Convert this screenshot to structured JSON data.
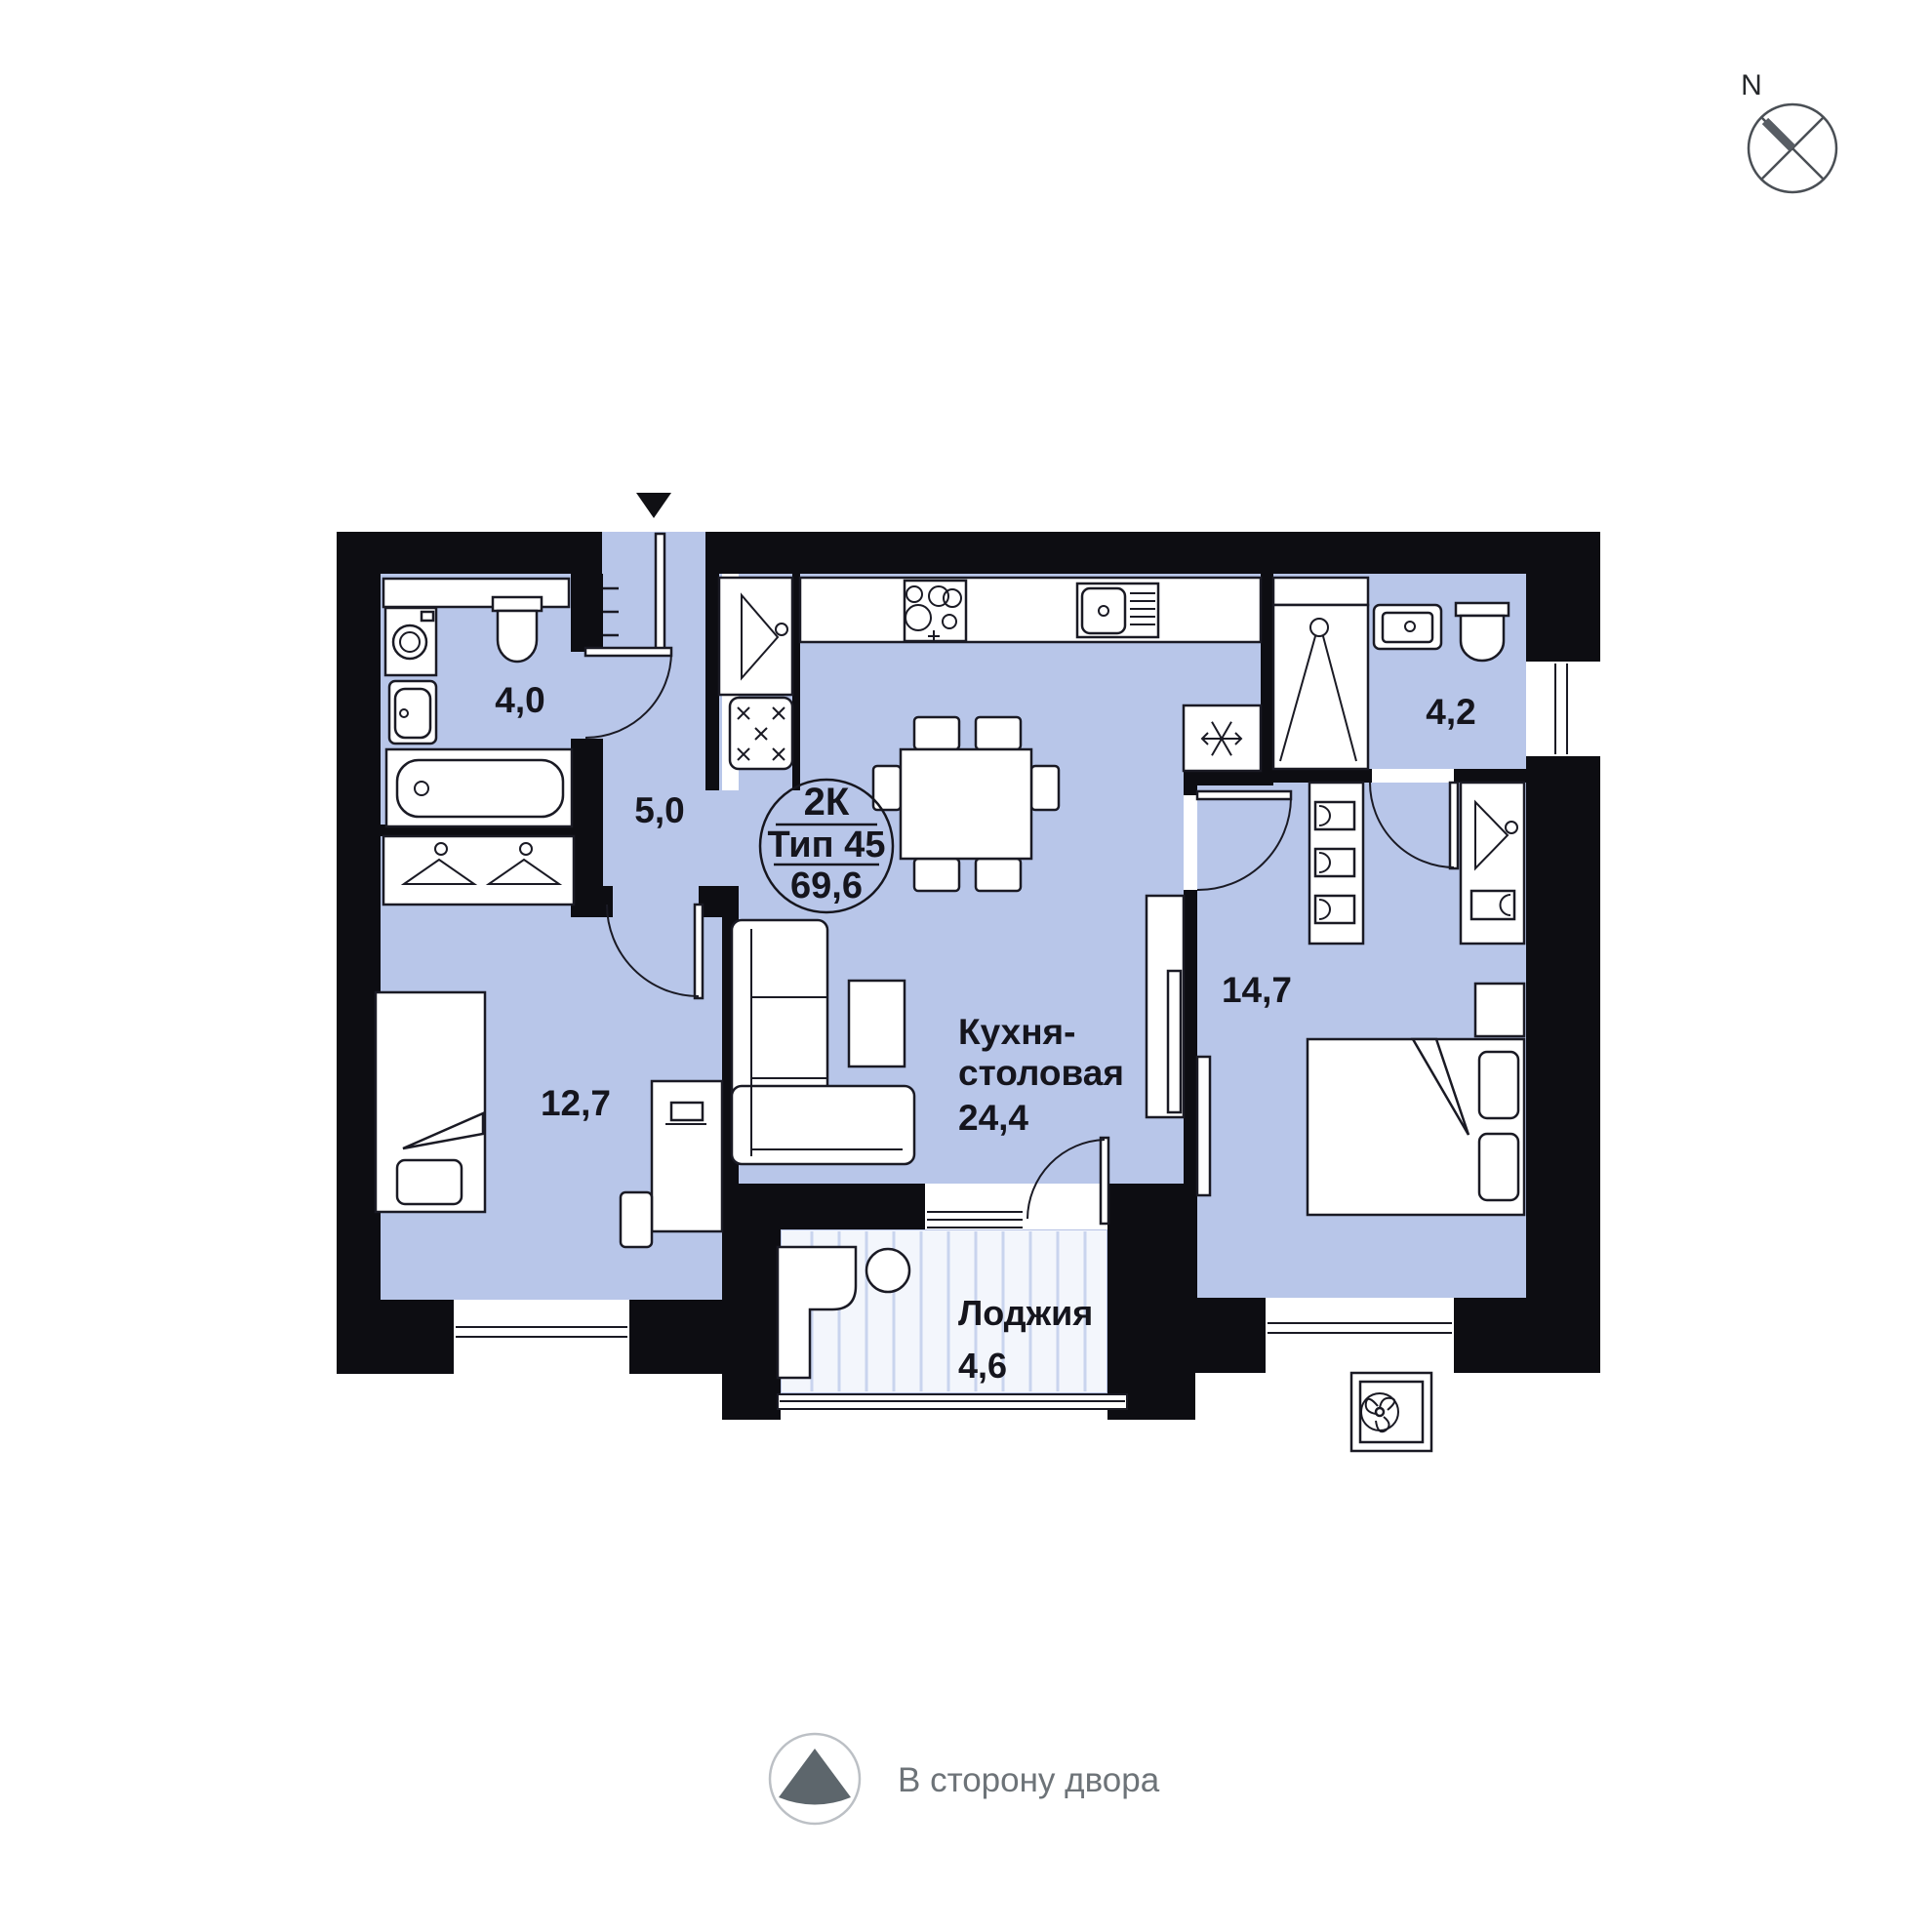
{
  "compass": {
    "north_label": "N"
  },
  "unit_badge": {
    "rooms": "2К",
    "type": "Тип 45",
    "area": "69,6"
  },
  "rooms": {
    "bathroom_small": {
      "area": "4,0"
    },
    "hallway": {
      "area": "5,0"
    },
    "bedroom_left": {
      "area": "12,7"
    },
    "kitchen": {
      "name_line1": "Кухня-",
      "name_line2": "столовая",
      "area": "24,4"
    },
    "bedroom_right": {
      "area": "14,7"
    },
    "bathroom_large": {
      "area": "4,2"
    },
    "loggia": {
      "name": "Лоджия",
      "area": "4,6"
    }
  },
  "legend": {
    "courtyard_label": "В сторону двора"
  },
  "colors": {
    "floor_fill": "#b8c6e9",
    "walls": "#0d0d12",
    "outline": "#1a1a24",
    "loggia_floor": "#f3f6fc",
    "loggia_stripe": "#c9d4ee",
    "legend_text": "#6d7378",
    "legend_arrow": "#5d666c"
  }
}
